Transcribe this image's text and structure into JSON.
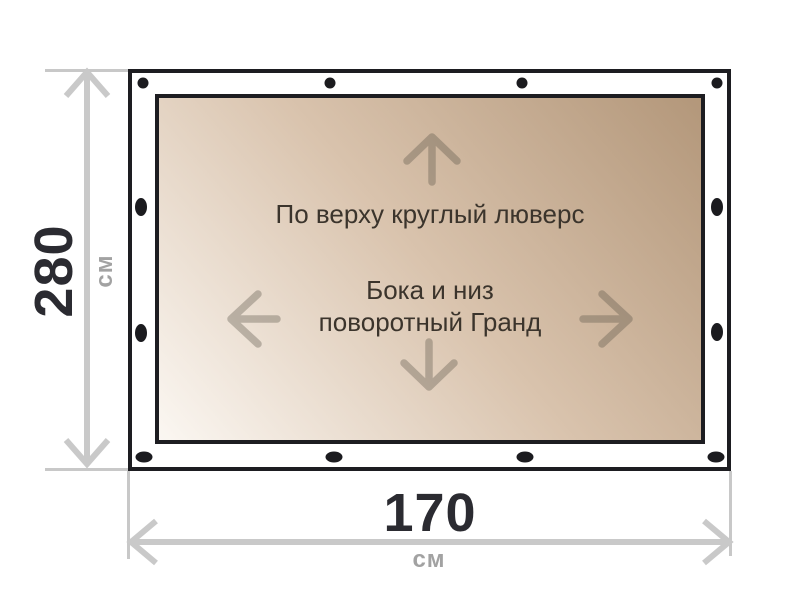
{
  "figure": {
    "type": "product-size-diagram",
    "notes": {
      "top_edge": "По верху круглый люверс",
      "body_line1": "Бока и низ",
      "body_line2": "поворотный Гранд"
    },
    "height": {
      "value": "280",
      "unit": "см"
    },
    "width": {
      "value": "170",
      "unit": "см"
    },
    "grommets": {
      "top": 4,
      "bottom": 4,
      "left": 2,
      "right": 2
    },
    "colors": {
      "frame_border": "#1d1d21",
      "grommet": "#1b1b1f",
      "fabric_gradient_light": "#fbf7f2",
      "fabric_gradient_mid": "#d9c3ad",
      "fabric_gradient_dark": "#b3977a",
      "dimension_line": "#c9c9c9",
      "dimension_value_text": "#2b2b31",
      "dimension_unit_text": "#a2a2a2",
      "note_text": "#3b342c",
      "direction_arrow": "#555244"
    }
  }
}
